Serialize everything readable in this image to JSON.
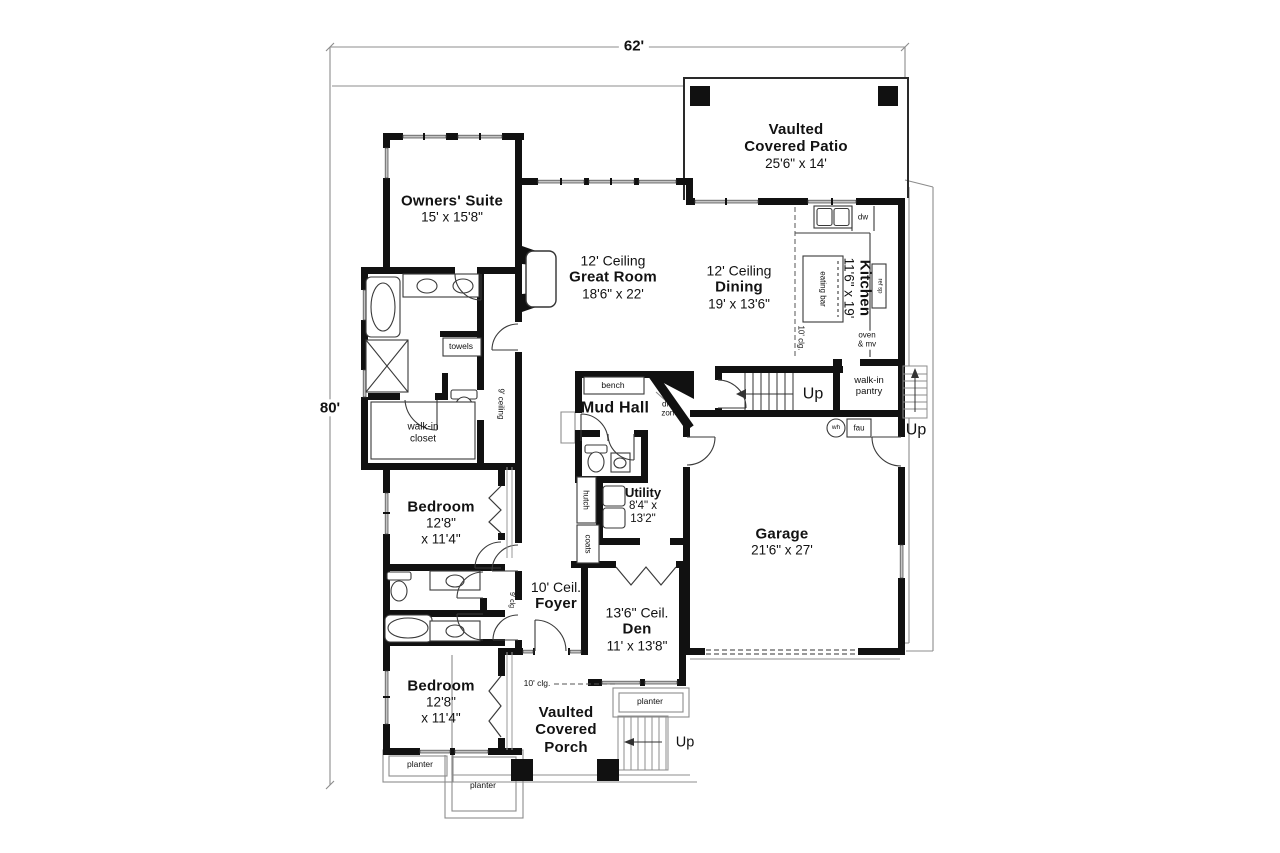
{
  "plan": {
    "overall_width": "62'",
    "overall_height": "80'"
  },
  "rooms": {
    "patio": {
      "line1": "Vaulted",
      "line2": "Covered Patio",
      "line3": "25'6\" x 14'"
    },
    "owners_suite": {
      "line1": "Owners' Suite",
      "line2": "15' x 15'8\""
    },
    "great_room": {
      "line1": "12' Ceiling",
      "line2": "Great Room",
      "line3": "18'6\" x 22'"
    },
    "dining": {
      "line1": "12' Ceiling",
      "line2": "Dining",
      "line3": "19' x 13'6\""
    },
    "kitchen": {
      "line1": "Kitchen",
      "line2": "11'6\" x 19'"
    },
    "mud_hall": {
      "line1": "Mud Hall"
    },
    "utility": {
      "line1": "Utility",
      "line2": "8'4\" x",
      "line3": "13'2\""
    },
    "bedroom_upper": {
      "line1": "Bedroom",
      "line2": "12'8\"",
      "line3": "x 11'4\""
    },
    "bedroom_lower": {
      "line1": "Bedroom",
      "line2": "12'8\"",
      "line3": "x 11'4\""
    },
    "foyer": {
      "line1": "10' Ceil.",
      "line2": "Foyer"
    },
    "den": {
      "line1": "13'6\" Ceil.",
      "line2": "Den",
      "line3": "11' x 13'8\""
    },
    "garage": {
      "line1": "Garage",
      "line2": "21'6\" x 27'"
    },
    "porch": {
      "line1": "Vaulted",
      "line2": "Covered",
      "line3": "Porch"
    }
  },
  "features": {
    "walk_in_closet": {
      "line1": "walk-in",
      "line2": "closet"
    },
    "walk_in_pantry": {
      "line1": "walk-in",
      "line2": "pantry"
    },
    "towels": "towels",
    "bench": "bench",
    "drop_zone": {
      "line1": "drop",
      "line2": "zone"
    },
    "hutch": "hutch",
    "coats": "coats",
    "eating_bar": "eating bar",
    "oven_mv": {
      "line1": "oven",
      "line2": "& mv"
    },
    "dw": "dw",
    "ref": "ref sp",
    "wh": "wh",
    "fau": "fau",
    "planter": "planter",
    "up": "Up",
    "ceiling_9": "9' ceiling",
    "clg_9": "9' clg",
    "clg_10_kitchen": "10' clg.",
    "clg_10_porch": "10' clg."
  },
  "colors": {
    "wall": "#111111",
    "thin_line": "#8c8c8c",
    "window_fill": "#c4c4c4",
    "background": "#ffffff"
  }
}
